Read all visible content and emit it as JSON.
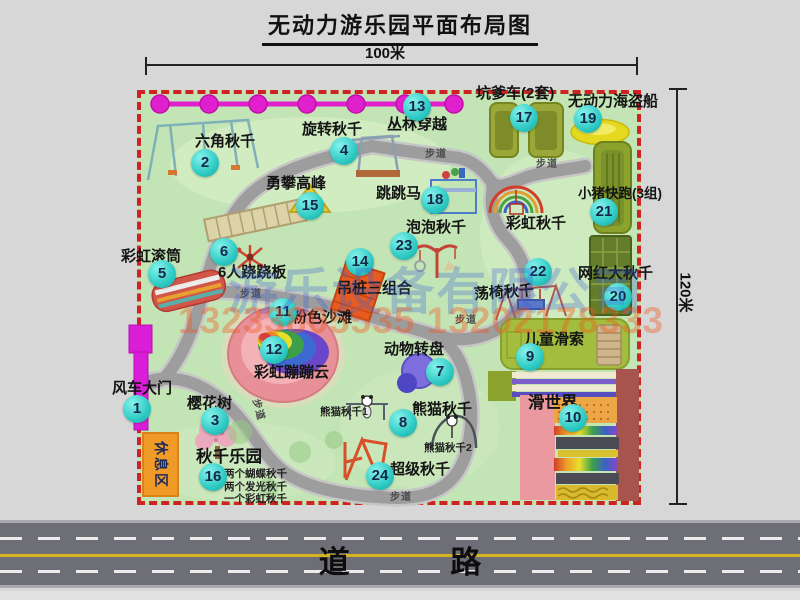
{
  "title": "无动力游乐园平面布局图",
  "dimensions": {
    "width_label": "100米",
    "height_label": "120米"
  },
  "road": {
    "label": "道 路"
  },
  "watermark": {
    "company": "游乐设备有限公司",
    "phone": "13233805535 13202178333"
  },
  "map": {
    "walkway_label": "步道"
  },
  "areas": {
    "rest_area": "休息区",
    "rainbow_swing": "彩虹秋千"
  },
  "items": [
    {
      "num": "1",
      "label": "风车大门"
    },
    {
      "num": "2",
      "label": "六角秋千"
    },
    {
      "num": "3",
      "label": "樱花树"
    },
    {
      "num": "4",
      "label": "旋转秋千"
    },
    {
      "num": "5",
      "label": "彩虹滚筒"
    },
    {
      "num": "6",
      "label": "6人跷跷板"
    },
    {
      "num": "7",
      "label": "动物转盘"
    },
    {
      "num": "8",
      "label": "熊猫秋千",
      "sub": [
        "熊猫秋千1",
        "熊猫秋千2"
      ]
    },
    {
      "num": "9",
      "label": "儿童滑索"
    },
    {
      "num": "10",
      "label": "滑世界"
    },
    {
      "num": "11",
      "label": "粉色沙滩"
    },
    {
      "num": "12",
      "label": "彩虹蹦蹦云"
    },
    {
      "num": "13",
      "label": "丛林穿越"
    },
    {
      "num": "14",
      "label": "吊桩三组合"
    },
    {
      "num": "15",
      "label": "勇攀高峰"
    },
    {
      "num": "16",
      "label": "秋千乐园",
      "sub": [
        "两个蝴蝶秋千",
        "两个发光秋千",
        "一个彩虹秋千"
      ]
    },
    {
      "num": "17",
      "label": "坑爹车(2套)"
    },
    {
      "num": "18",
      "label": "跳跳马"
    },
    {
      "num": "19",
      "label": "无动力海盗船"
    },
    {
      "num": "20",
      "label": "网红大秋千"
    },
    {
      "num": "21",
      "label": "小猪快跑(3组)"
    },
    {
      "num": "22",
      "label": "荡椅秋千"
    },
    {
      "num": "23",
      "label": "泡泡秋千"
    },
    {
      "num": "24",
      "label": "超级秋千"
    }
  ],
  "colors": {
    "park_green": "#c3e5b5",
    "border_red": "#cf2323",
    "badge_cyan": "#2fcac4",
    "zipline_magenta": "#e020cc",
    "gate_magenta": "#da1ed8",
    "rest_orange": "#f09a28",
    "road_gray": "#6e6e76",
    "road_yellow": "#d4b422"
  }
}
